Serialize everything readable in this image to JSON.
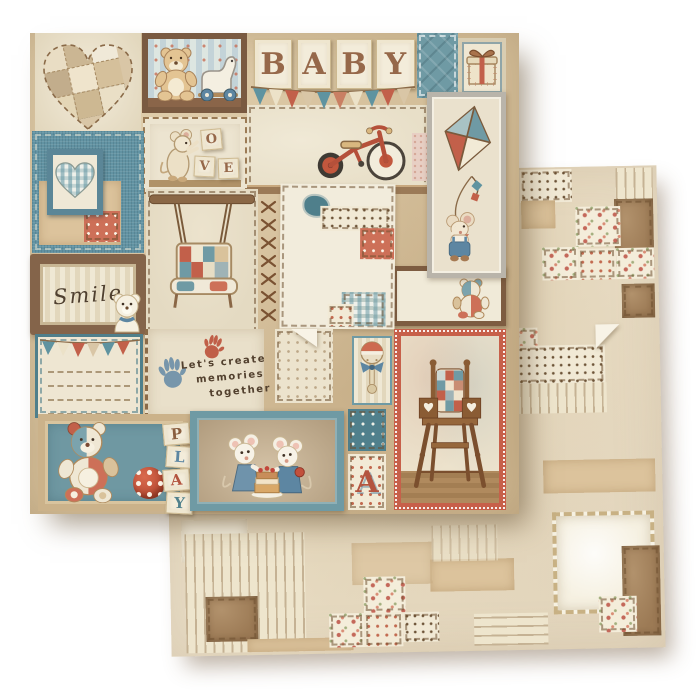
{
  "colors": {
    "background": "#ffffff",
    "paper_cream": "#ece3cf",
    "paper_tan": "#d3bd98",
    "teal": "#6f9aa4",
    "denim_blue": "#6293a3",
    "coral_red": "#c2604a",
    "wood_brown": "#7d5f46",
    "text_brown": "#52402e"
  },
  "front_sheet": {
    "baby_blocks": {
      "letters": [
        "B",
        "A",
        "B",
        "Y"
      ]
    },
    "love_blocks": {
      "letters": [
        "O",
        "V",
        "E"
      ]
    },
    "smile_card": {
      "text": "Smile"
    },
    "memories_card": {
      "line1": "Let's create",
      "line2": "memories",
      "line3": "together"
    },
    "play_blocks": {
      "letters": [
        "P",
        "L",
        "A",
        "Y"
      ]
    },
    "letter_a_block": {
      "letter": "A"
    },
    "illustrations": {
      "patchwork-heart": "stitched patchwork heart",
      "teddy-and-pull-toy": "teddy bear with pull toy on shelf",
      "gift-box": "wrapped gift box",
      "bunting": "triangle flag banner",
      "tricycle": "red tricycle on shelf",
      "mouse-with-blocks": "mouse stacking letter blocks",
      "mouse-with-kite": "mouse holding patchwork kite",
      "gingham-heart": "gingham heart in blue frame",
      "swing": "hanging patchwork swing bench",
      "cross-stitches": "cross stitch seam",
      "teddy-in-frame": "small patchwork teddy in wooden frame",
      "handprints": "red and blue baby handprints",
      "rattle": "baby rattle with bow",
      "high-chair": "wooden high chair with patchwork quilt",
      "patchwork-teddy-with-ball": "patchwork teddy bear with polka dot ball",
      "mice-with-cake": "two mice sharing a layer cake",
      "smile-bear": "small bear beside smile frame"
    }
  },
  "back_sheet": {
    "pattern": "patchwork quilt collage of floral, polka dot, striped, tan and brown fabric patches"
  }
}
